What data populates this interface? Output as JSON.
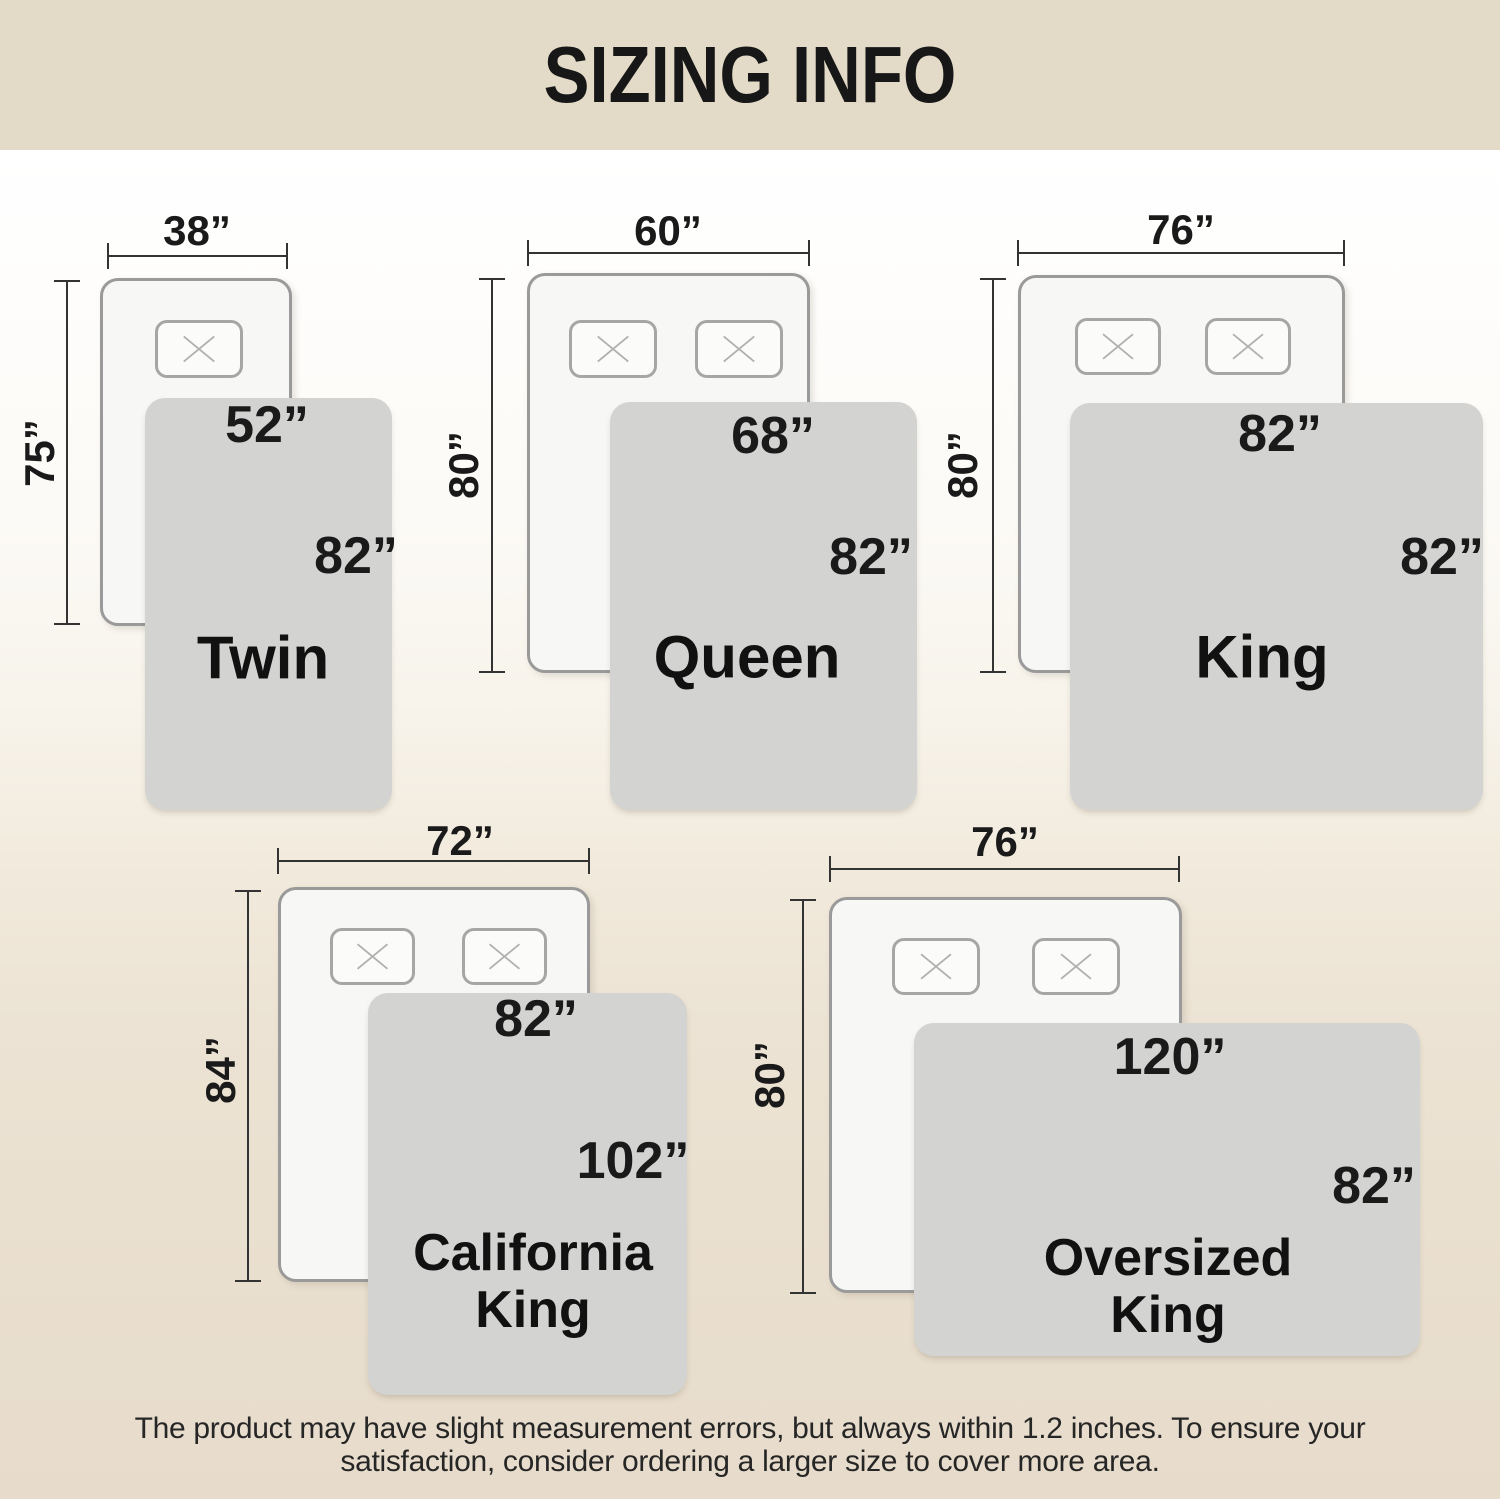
{
  "title": "SIZING INFO",
  "icons": {
    "pillow_cross": "✕"
  },
  "colors": {
    "banner": "#e3dac7",
    "background_bottom": "#e7dccb",
    "blanket": "#d3d3d1",
    "mattress_fill": "#f7f7f5",
    "mattress_border": "#9a9a9a",
    "text": "#1a1a1a"
  },
  "sizes": [
    {
      "name": "Twin",
      "mattress_width": "38”",
      "mattress_length": "75”",
      "blanket_width": "52”",
      "blanket_length": "82”",
      "pillow_count": 1
    },
    {
      "name": "Queen",
      "mattress_width": "60”",
      "mattress_length": "80”",
      "blanket_width": "68”",
      "blanket_length": "82”",
      "pillow_count": 2
    },
    {
      "name": "King",
      "mattress_width": "76”",
      "mattress_length": "80”",
      "blanket_width": "82”",
      "blanket_length": "82”",
      "pillow_count": 2
    },
    {
      "name": "California King",
      "name_line1": "California",
      "name_line2": "King",
      "mattress_width": "72”",
      "mattress_length": "84”",
      "blanket_width": "82”",
      "blanket_length": "102”",
      "pillow_count": 2
    },
    {
      "name": "Oversized King",
      "name_line1": "Oversized",
      "name_line2": "King",
      "mattress_width": "76”",
      "mattress_length": "80”",
      "blanket_width": "120”",
      "blanket_length": "82”",
      "pillow_count": 2
    }
  ],
  "footer": {
    "line1": "The product may have slight measurement errors, but always within 1.2 inches. To ensure your",
    "line2": "satisfaction, consider ordering a larger size to cover more area."
  }
}
